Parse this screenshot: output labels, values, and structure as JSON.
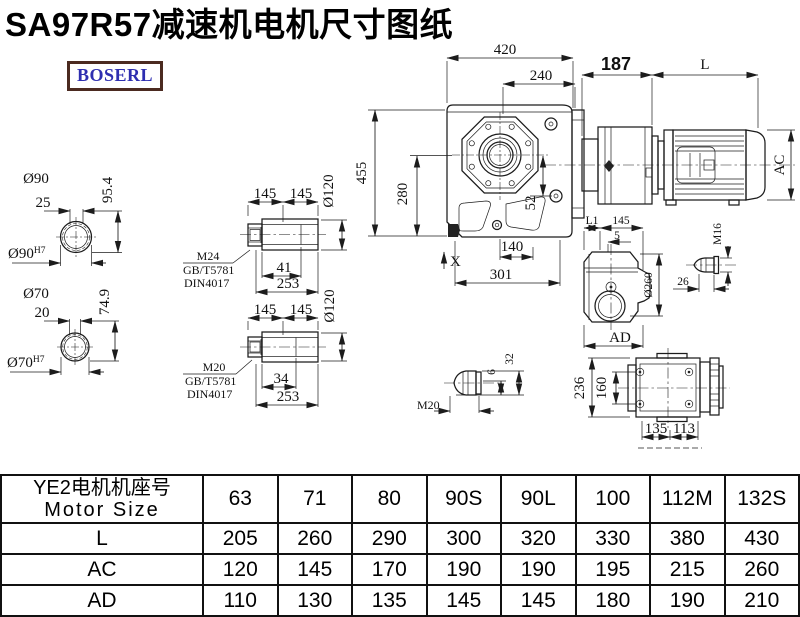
{
  "title": "SA97R57减速机电机尺寸图纸",
  "logo": "BOSERL",
  "drawing": {
    "main_view": {
      "dim_width_top": "420",
      "dim_width_inner": "240",
      "dim_height": "455",
      "dim_height_half": "280",
      "dim_offset": "52",
      "mark_x": "X",
      "dim_bottom_inner": "140",
      "dim_bottom_total": "301"
    },
    "motor_assembly": {
      "dim_adapter": "187",
      "dim_motor_length": "L",
      "dim_motor_dia": "AC"
    },
    "hollow_shaft_90": {
      "dia_label": "Ø90",
      "key_width": "25",
      "key_depth": "95.4",
      "bore_fit": "Ø90",
      "bore_fit_sup": "H7"
    },
    "hollow_shaft_70": {
      "dia_label": "Ø70",
      "key_width": "20",
      "key_depth": "74.9",
      "bore_fit": "Ø70",
      "bore_fit_sup": "H7"
    },
    "bushing_m24": {
      "seg1": "145",
      "seg2": "145",
      "dia": "Ø120",
      "bolt": "M24",
      "std1": "GB/T5781",
      "std2": "DIN4017",
      "depth": "41",
      "length": "253"
    },
    "bushing_m20": {
      "seg1": "145",
      "seg2": "145",
      "dia": "Ø120",
      "bolt": "M20",
      "std1": "GB/T5781",
      "std2": "DIN4017",
      "depth": "34",
      "length": "253"
    },
    "side_view": {
      "dim_l1": "L1",
      "dim_145": "145",
      "dim_5": "5",
      "dia": "Ø260",
      "dim_ad": "AD"
    },
    "bolt_m16": {
      "label": "M16",
      "length": "26"
    },
    "bolt_m20": {
      "label": "M20",
      "dim_6": "6",
      "dim_32": "32"
    },
    "rear_view": {
      "dim_236": "236",
      "dim_160": "160",
      "dim_135": "135",
      "dim_113": "113"
    }
  },
  "table": {
    "header_cn": "YE2电机机座号",
    "header_en": "Motor Size",
    "columns": [
      "63",
      "71",
      "80",
      "90S",
      "90L",
      "100",
      "112M",
      "132S"
    ],
    "rows": [
      {
        "label": "L",
        "values": [
          "205",
          "260",
          "290",
          "300",
          "320",
          "330",
          "380",
          "430"
        ]
      },
      {
        "label": "AC",
        "values": [
          "120",
          "145",
          "170",
          "190",
          "190",
          "195",
          "215",
          "260"
        ]
      },
      {
        "label": "AD",
        "values": [
          "110",
          "130",
          "135",
          "145",
          "145",
          "180",
          "190",
          "210"
        ]
      }
    ]
  }
}
